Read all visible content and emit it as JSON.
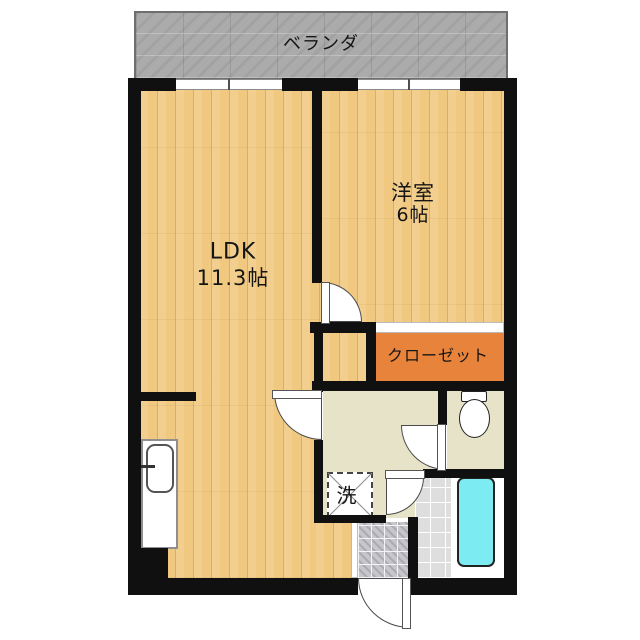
{
  "rooms": {
    "balcony": {
      "label": "ベランダ"
    },
    "ldk": {
      "name": "LDK",
      "size": "11.3帖"
    },
    "western_room": {
      "name": "洋室",
      "size": "6帖"
    },
    "closet": {
      "label": "クローゼット"
    },
    "washer": {
      "label": "洗"
    }
  },
  "colors": {
    "wall": "#101010",
    "wood": "#f0c87f",
    "wood-line": "#dcae63",
    "closet": "#e8833c",
    "balcony": "#ababab",
    "washroom-floor": "#e6e3c9",
    "bath-tile": "#dedede",
    "entrance-tile": "#c6c6cc",
    "bathtub": "#7debf2"
  }
}
